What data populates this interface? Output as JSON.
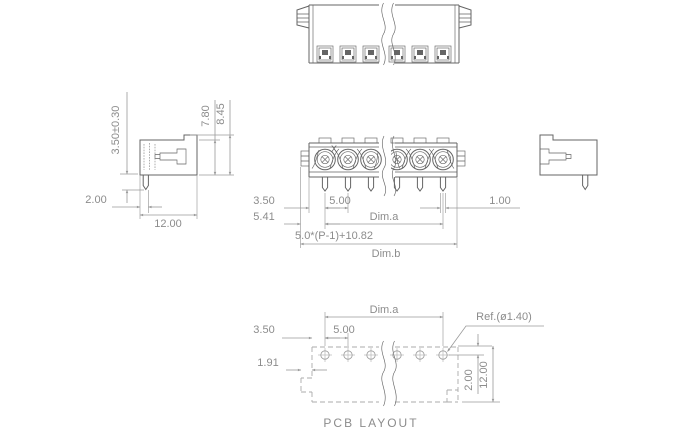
{
  "drawing": {
    "title": "PCB LAYOUT",
    "polarity_mark": "X",
    "front_view": {
      "edge_to_pin": "3.50",
      "pitch": "5.00",
      "pin_width": "1.00",
      "flange_to_pin": "5.41",
      "pin_span_label": "Dim.a",
      "overall_formula": "5.0*(P-1)+10.82",
      "overall_label": "Dim.b"
    },
    "side_view": {
      "pin_length": "3.50±0.30",
      "body_height": "7.80",
      "overall_height": "8.45",
      "pin_to_face": "2.00",
      "body_depth": "12.00"
    },
    "pcb_layout": {
      "edge_to_hole": "3.50",
      "pitch": "5.00",
      "hole_span_label": "Dim.a",
      "hole_diameter_ref": "Ref.(ø1.40)",
      "flange_offset": "1.91",
      "hole_to_edge": "2.00",
      "outline_depth": "12.00"
    }
  },
  "colors": {
    "bg": "#ffffff",
    "part": "#646464",
    "dim": "#9a9a9a",
    "dash": "#ababab",
    "hair": "#b3b3b3",
    "text": "#8c8c8c"
  }
}
